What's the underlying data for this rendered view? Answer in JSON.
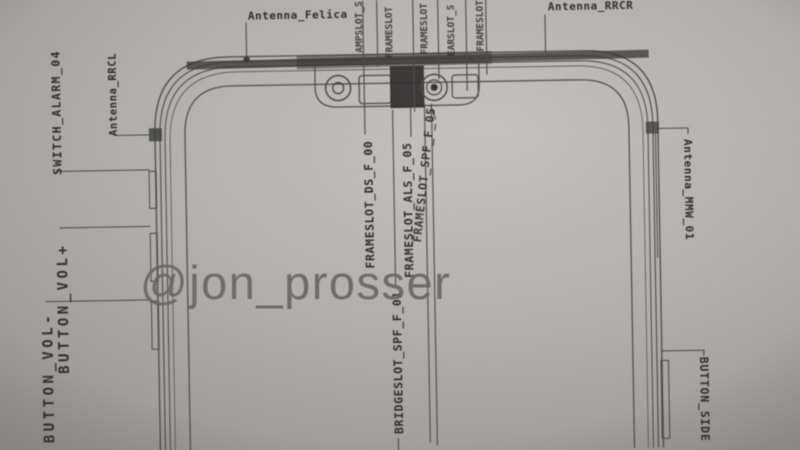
{
  "source": {
    "watermark": "@jon_prosser"
  },
  "colors": {
    "paper": "#b7b5b2",
    "ink": "#2b2a27",
    "line": "#4a4742",
    "watermark": "#676665"
  },
  "schematic": {
    "type": "smartphone-front-cad-drawing",
    "labels": {
      "antenna_felica": "Antenna_Felica",
      "antenna_rrcr": "Antenna_RRCR",
      "antenna_rrcl": "Antenna_RRCL",
      "switch_alarm": "SWITCH_ALARM_04",
      "button_vol_plus": "BUTTON_VOL+",
      "button_vol_minus": "BUTTON_VOL-",
      "frameslot_ds": "FRAMESLOT_DS_F_00",
      "frameslot_als": "FRAMESLOT_ALS_F_05",
      "frameslot_spf": "FRAMESLOT_SPF_F_05",
      "bridgeslot_spf": "BRIDGESLOT_SPF_F_01",
      "antenna_mmw": "Antenna_MMW_01",
      "button_side": "BUTTON_SIDE",
      "cut_top_1": "AMPSLOT_S",
      "cut_top_2": "FRAMESLOT",
      "cut_top_3": "FRAMESLOT",
      "cut_top_4": "EARSLOT_S",
      "cut_top_5": "FRAMESLOT"
    }
  }
}
